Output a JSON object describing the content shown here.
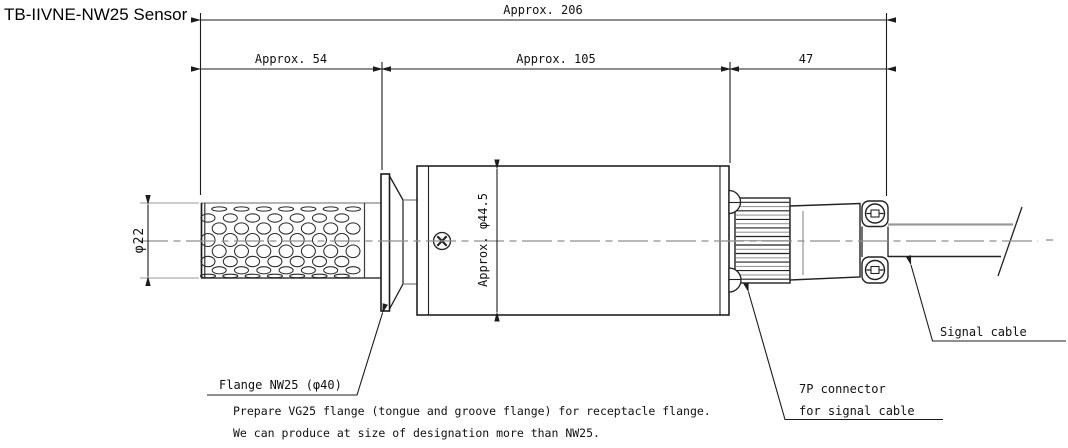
{
  "title": "TB-IIVNE-NW25 Sensor",
  "dimensions": {
    "overall_length": "Approx. 206",
    "probe_length": "Approx. 54",
    "body_length": "Approx. 105",
    "connector_length": "47",
    "probe_diameter": "φ22",
    "body_diameter": "Approx. φ44.5"
  },
  "callouts": {
    "flange": "Flange NW25 (φ40)",
    "connector_line1": "7P connector",
    "connector_line2": "for signal cable",
    "signal_cable": "Signal cable"
  },
  "notes": [
    "Prepare VG25 flange (tongue and groove flange) for receptacle flange.",
    "We can produce at size of designation more than NW25."
  ],
  "colors": {
    "line": "#1c1c1c",
    "secondary_line": "#949494",
    "text": "#111111",
    "background": "#ffffff"
  }
}
